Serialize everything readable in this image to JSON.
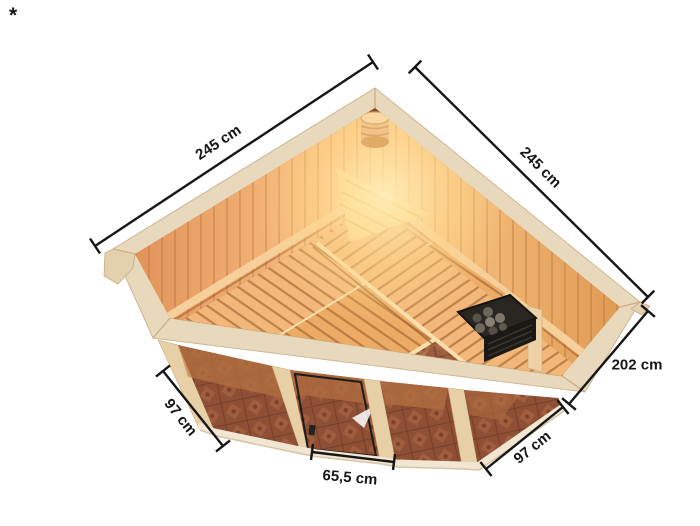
{
  "page": {
    "footnote_marker": "*",
    "background": "#ffffff"
  },
  "diagram": {
    "type": "product-dimension-diagram",
    "subject": "corner sauna, elevated interior view",
    "unit": "cm",
    "dimensions": {
      "width_left_label": "245 cm",
      "width_right_label": "245 cm",
      "height_label": "202 cm",
      "depth_left_label": "97 cm",
      "depth_right_label": "97 cm",
      "door_width_label": "65,5 cm",
      "width_left_value": 245,
      "width_right_value": 245,
      "height_value": 202,
      "depth_left_value": 97,
      "depth_right_value": 97,
      "door_width_value": 65.5
    },
    "colors": {
      "dimension_line": "#161616",
      "rim_beige": "#e9d9bc",
      "wood_warm": "#f2a95f",
      "wood_light": "#ffcf8e",
      "glow": "#ffe3a0",
      "floor_tile": "#9a5a40",
      "heater_dark": "#23211e",
      "glass_tint": "#7d3e23"
    }
  }
}
